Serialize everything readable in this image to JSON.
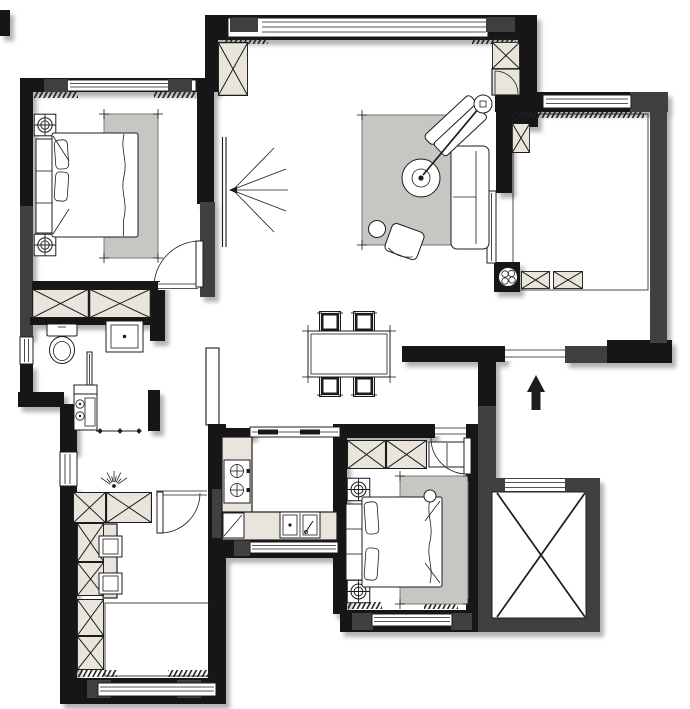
{
  "document": {
    "title": "apartment-floor-plan",
    "type": "architectural floor plan, top view, no text labels visible"
  },
  "colors": {
    "bg": "#ffffff",
    "wall": "#181818",
    "wall2": "#3f3f3f",
    "line": "#1c1c1c",
    "cabinet": "#e9e5dc",
    "rug": "#c7c6c2",
    "deck_dark": "#8f8f8c",
    "deck_light": "#eae6da",
    "hatch": "#202020"
  },
  "rooms": [
    {
      "name": "master-bedroom",
      "position": "top-left",
      "features": [
        "double-bed",
        "headboard",
        "two-nightstand-lamps",
        "area-rug",
        "two-x-wardrobes",
        "window",
        "swing-door"
      ]
    },
    {
      "name": "bathroom",
      "position": "left-middle",
      "features": [
        "toilet",
        "washbasin-vanity",
        "sliding-door",
        "small-window"
      ]
    },
    {
      "name": "laundry-hall",
      "position": "left-center",
      "features": [
        "washing-unit-two-circles",
        "wall-shelf-with-diamonds",
        "radiating-light-symbol",
        "two-x-wardrobes"
      ]
    },
    {
      "name": "study",
      "position": "bottom-left",
      "features": [
        "four-x-cabinet-column",
        "desk-strip",
        "two-stools",
        "light-parquet-floor",
        "window",
        "swing-door"
      ]
    },
    {
      "name": "kitchen",
      "position": "bottom-center",
      "features": [
        "l-shaped-counter",
        "two-burner-stove",
        "double-sink-with-tap",
        "corner-cabinet",
        "pass-through-window",
        "window"
      ]
    },
    {
      "name": "second-bedroom",
      "position": "bottom-right",
      "features": [
        "double-bed",
        "two-nightstand-lamps",
        "two-x-wardrobes",
        "open-shelf",
        "area-rug",
        "swing-door",
        "window"
      ]
    },
    {
      "name": "living-dining",
      "position": "center",
      "features": [
        "wall-mounted-tv-with-view-lines",
        "straight-sofa",
        "angled-loveseat",
        "armchair",
        "arc-floor-lamp",
        "side-table",
        "area-rug",
        "dining-table",
        "four-dining-chairs",
        "picture-window"
      ]
    },
    {
      "name": "balcony",
      "position": "top-right",
      "features": [
        "dark-basketweave-deck",
        "potted-plant",
        "two-low-x-cabinets",
        "x-storage-inset",
        "sliding-door",
        "window"
      ]
    },
    {
      "name": "entry-corridor",
      "position": "right-middle",
      "features": [
        "entry-direction-arrow",
        "front-door-opening"
      ]
    },
    {
      "name": "elevator",
      "position": "bottom-right-corner",
      "features": [
        "shaft-with-x-cross",
        "door-opening"
      ]
    },
    {
      "name": "service-shaft",
      "position": "center-left-of-kitchen",
      "features": [
        "diagonal-hatch-duct"
      ]
    }
  ],
  "symbols": [
    "double-bed",
    "nightstand-lamp",
    "wardrobe-x-box",
    "rug-with-corner-ticks",
    "tv-viewing-fan",
    "sofa",
    "loveseat",
    "armchair",
    "arc-floor-lamp",
    "side-table",
    "dining-table",
    "dining-chair",
    "stool",
    "toilet",
    "washbasin",
    "washing-unit",
    "gas-stove",
    "kitchen-sink",
    "corner-cabinet",
    "potted-plant",
    "entry-arrow",
    "door-swing-arc",
    "sliding-door",
    "window-triple-line",
    "curtain-hatch",
    "parquet-basketweave",
    "duct-hatch",
    "elevator-x"
  ]
}
